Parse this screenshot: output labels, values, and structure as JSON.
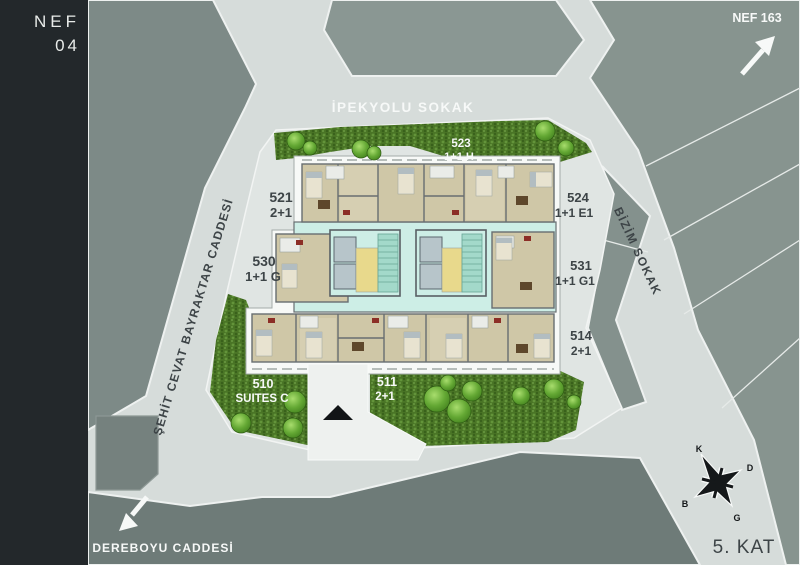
{
  "project": {
    "code_line1": "NEF",
    "code_line2": "04"
  },
  "floor": {
    "label": "5. KAT"
  },
  "offsite": {
    "label": "NEF 163",
    "arrow": "northeast-arrow"
  },
  "streets": {
    "top": "İPEKYOLU SOKAK",
    "left": "ŞEHİT CEVAT BAYRAKTAR CADDESİ",
    "right": "BİZİM SOKAK",
    "bottom_left": "DEREBOYU CADDESİ"
  },
  "units": [
    {
      "no": "523",
      "type": "1+1 H"
    },
    {
      "no": "521",
      "type": "2+1"
    },
    {
      "no": "524",
      "type": "1+1 E1"
    },
    {
      "no": "530",
      "type": "1+1 G"
    },
    {
      "no": "531",
      "type": "1+1 G1"
    },
    {
      "no": "514",
      "type": "2+1"
    },
    {
      "no": "510",
      "type": "SUITES C"
    },
    {
      "no": "511",
      "type": "2+1"
    }
  ],
  "compass": {
    "north": "K",
    "east": "D",
    "south": "G",
    "west": "B"
  },
  "colors": {
    "sidebar_dark": "#23282b",
    "road": "#d6dcda",
    "parcel": "#e0e5e3",
    "block_green_gray": "#84918d",
    "hedge_green": "#4a7526",
    "tree_green": "#64a834",
    "corridor_teal": "#cdeee6",
    "room_tan": "#cfc7a7",
    "core_yellow": "#e8d98c",
    "accent_red": "#8c2e26",
    "text_dark": "#3d4447",
    "text_white": "#f7f9f8"
  }
}
